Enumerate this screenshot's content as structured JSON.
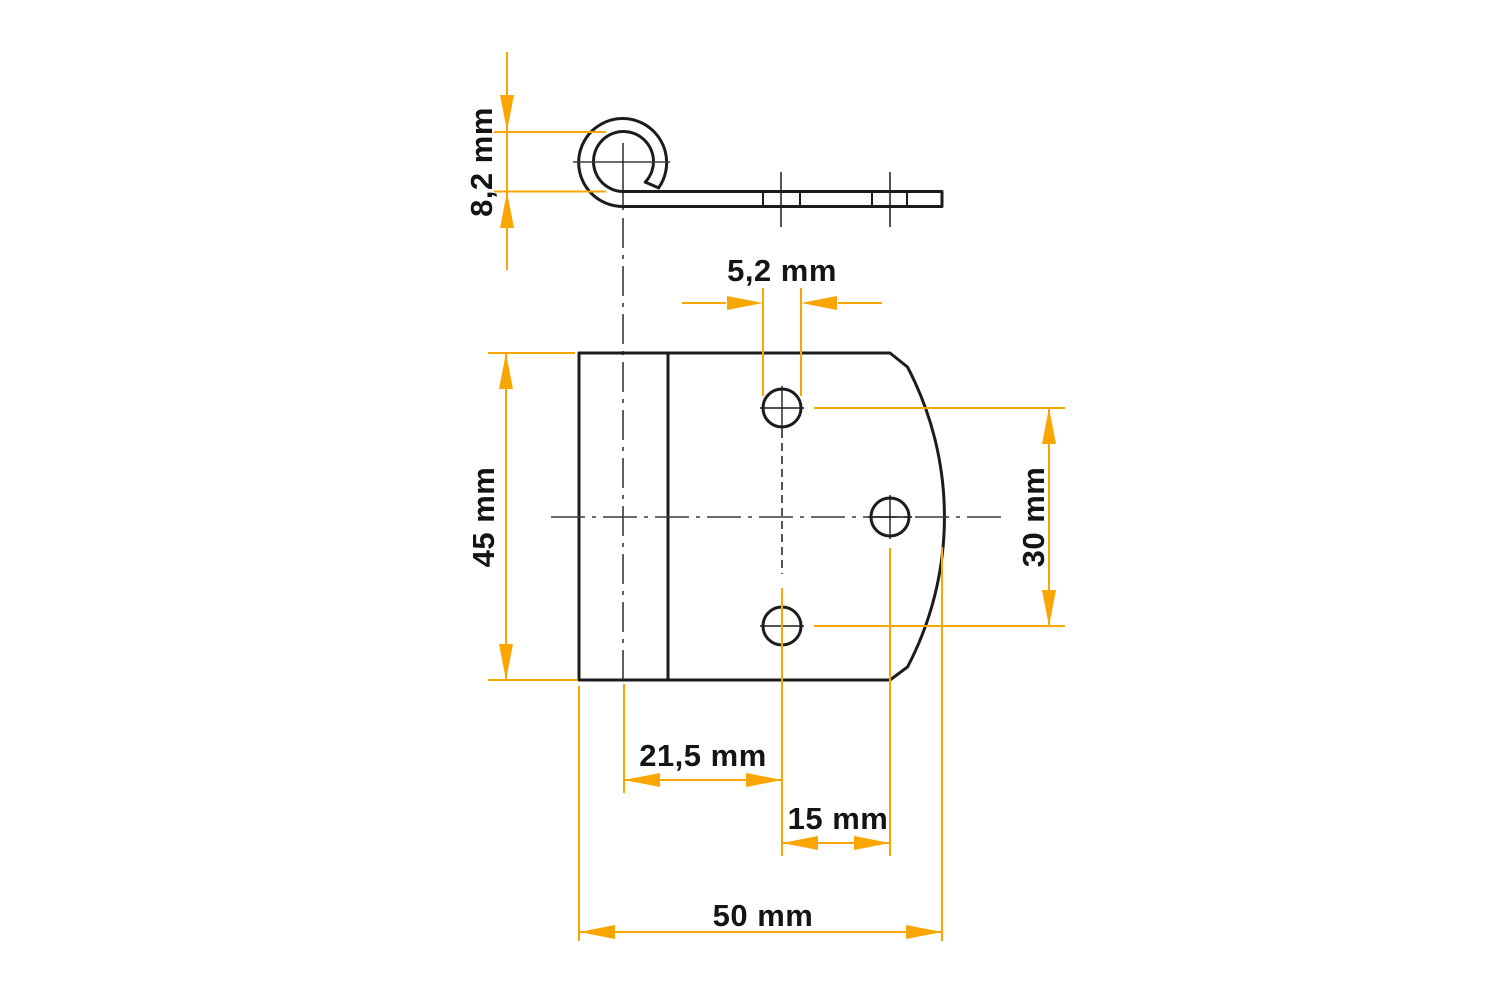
{
  "drawing": {
    "type": "technical-dimension-drawing",
    "part": "curled hinge bracket, side profile and front view",
    "unit": "mm"
  },
  "colors": {
    "accent_orange": "#F9A602",
    "part_line": "#1C1C1C",
    "centerline": "#3A3A3A",
    "text": "#141414",
    "background": "#FFFFFF"
  },
  "dimensions": {
    "curl_opening": {
      "label": "8,2 mm",
      "value": 8.2,
      "unit": "mm",
      "orientation": "vertical"
    },
    "hole_diameter": {
      "label": "5,2 mm",
      "value": 5.2,
      "unit": "mm",
      "orientation": "horizontal"
    },
    "plate_height": {
      "label": "45 mm",
      "value": 45,
      "unit": "mm",
      "orientation": "vertical"
    },
    "hole_span_vertical": {
      "label": "30 mm",
      "value": 30,
      "unit": "mm",
      "orientation": "vertical"
    },
    "bend_to_hole": {
      "label": "21,5 mm",
      "value": 21.5,
      "unit": "mm",
      "orientation": "horizontal"
    },
    "hole_span_horizontal": {
      "label": "15 mm",
      "value": 15,
      "unit": "mm",
      "orientation": "horizontal"
    },
    "plate_width": {
      "label": "50 mm",
      "value": 50,
      "unit": "mm",
      "orientation": "horizontal"
    }
  }
}
